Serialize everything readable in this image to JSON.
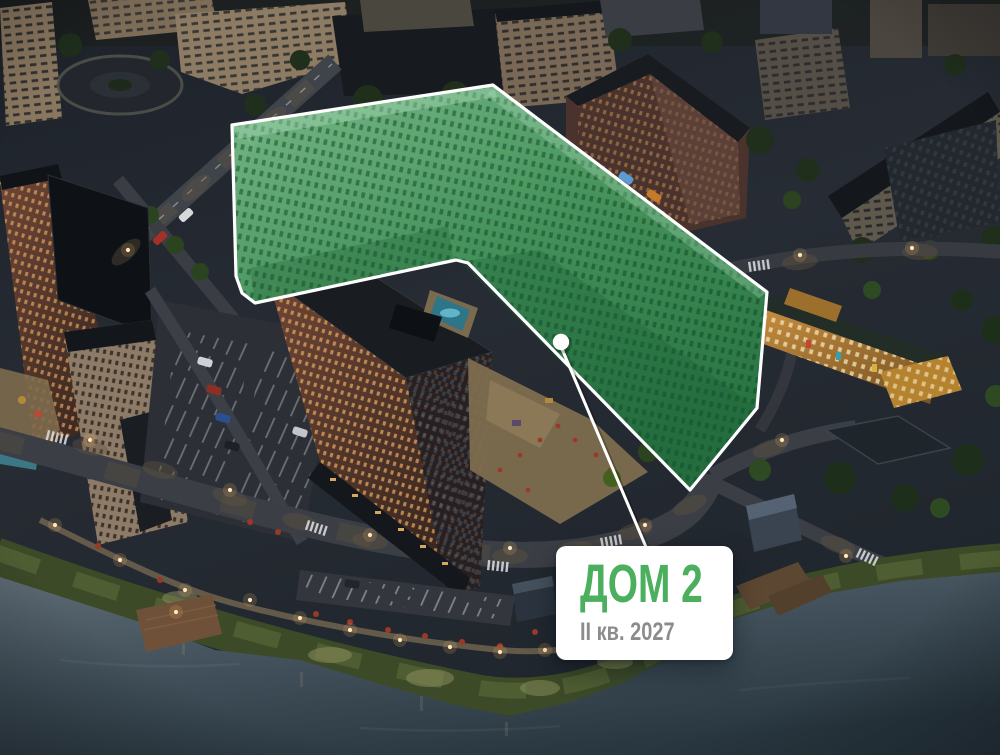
{
  "card": {
    "title": "ДОМ 2",
    "completion": "II кв. 2027"
  },
  "highlight": {
    "label": "Дом 2",
    "fill_color": "#3E9556",
    "border_color": "#FFFFFF"
  },
  "marker": {
    "icon": "marker-dot-icon",
    "color": "#FFFFFF"
  },
  "colors": {
    "accent_green": "#4CAF5E",
    "label_gray": "#8C8C8C",
    "card_bg": "#FFFFFF",
    "highlight_fill": "#3E9556",
    "highlight_border": "#FFFFFF"
  }
}
